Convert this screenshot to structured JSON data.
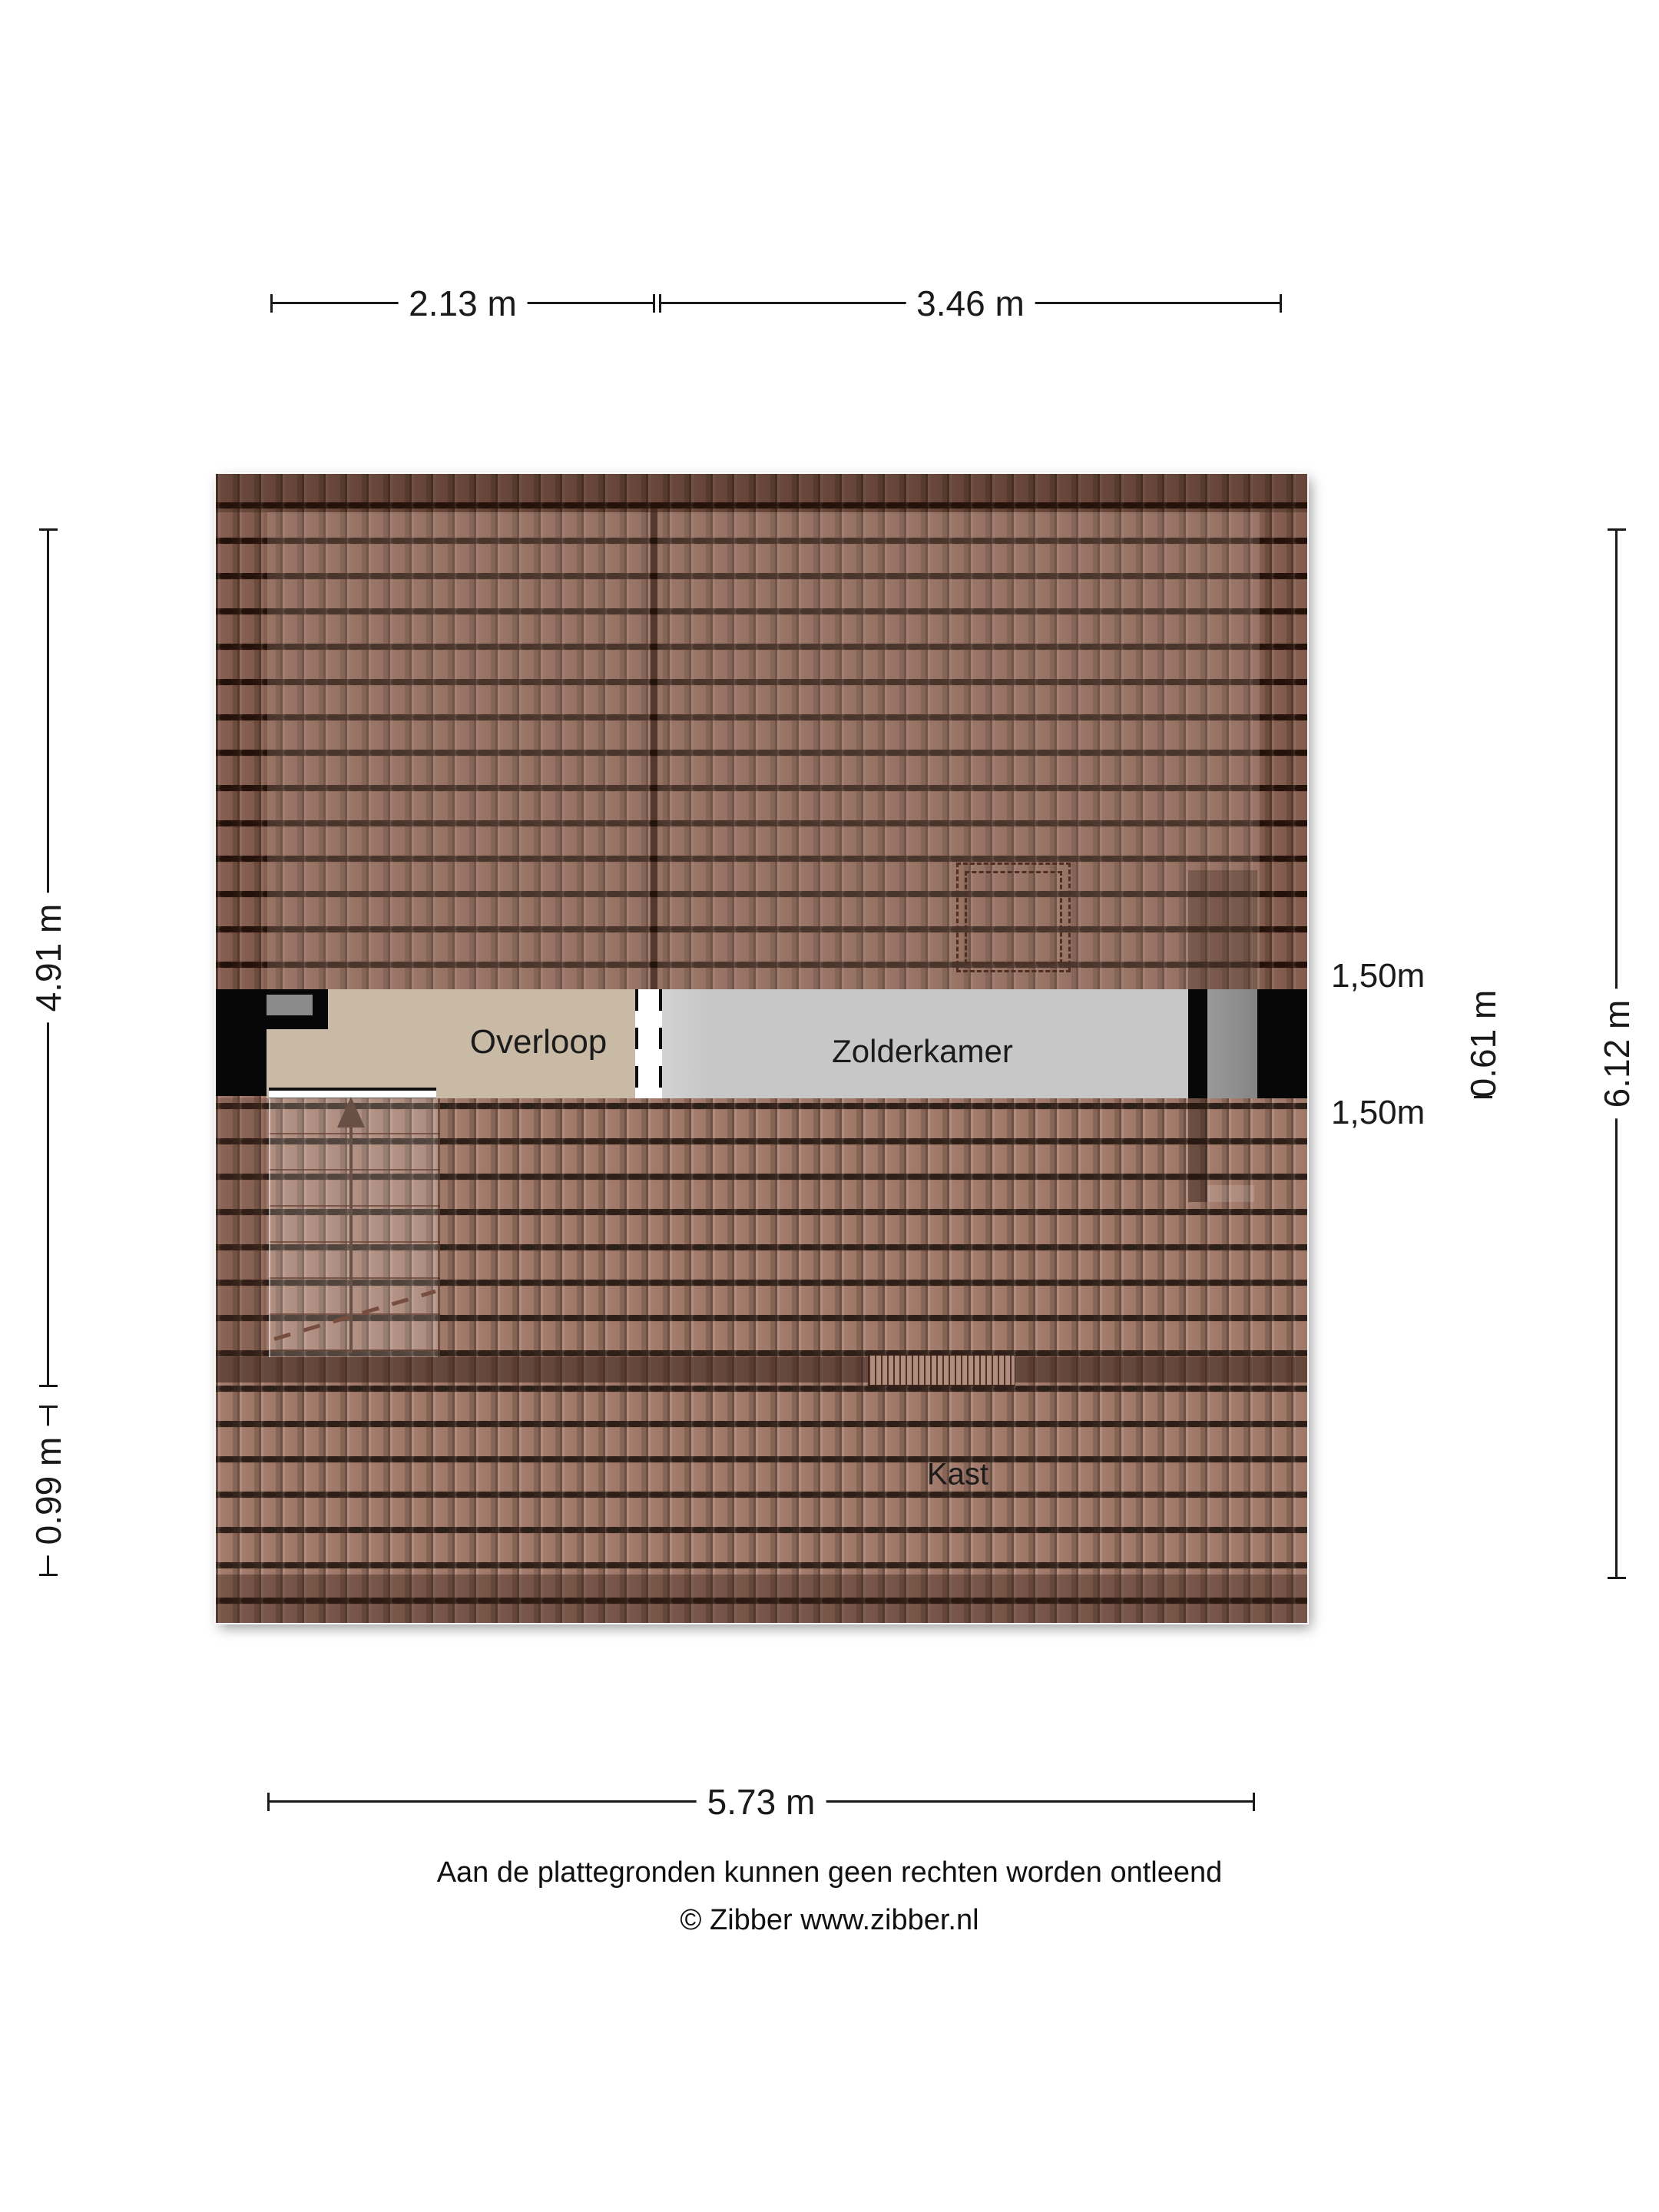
{
  "floorplan": {
    "rooms": {
      "overloop": "Overloop",
      "zolderkamer": "Zolderkamer",
      "kast": "Kast"
    },
    "height_lines": {
      "top": "1,50m",
      "bottom": "1,50m"
    },
    "dimensions": {
      "top_left": "2.13 m",
      "top_right": "3.46 m",
      "left_upper": "4.91 m",
      "left_lower": "0.99 m",
      "right_inner": "0.61 m",
      "right_outer": "6.12 m",
      "bottom": "5.73 m"
    },
    "colors": {
      "roof_tile_base": "#9c7160",
      "roof_tile_dark_border": "#6b4236",
      "roof_line": "#21110a",
      "overloop_floor": "#c9baa6",
      "zolderkamer_floor": "#c6c7c6",
      "wall_black": "#070707",
      "chimney_gray": "#8f8f8f",
      "stair_arrow": "#5d4438"
    }
  },
  "footer": {
    "disclaimer": "Aan de plattegronden kunnen geen rechten worden ontleend",
    "copyright": "© Zibber www.zibber.nl"
  }
}
